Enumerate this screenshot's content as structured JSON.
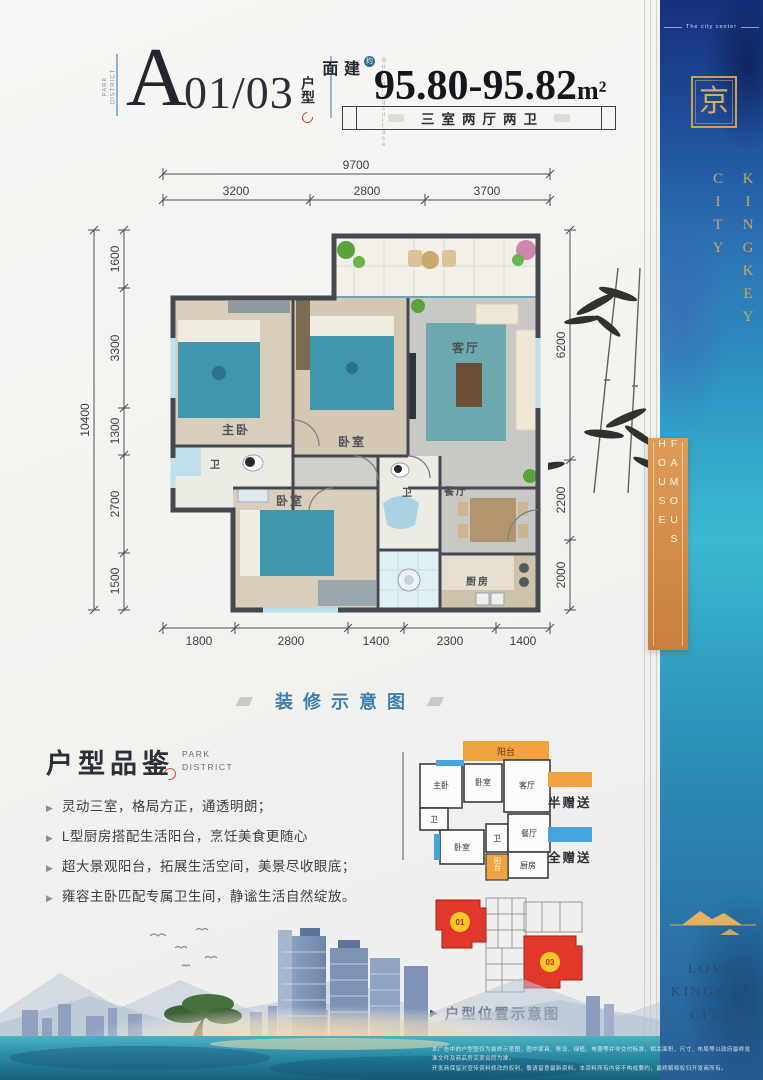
{
  "colors": {
    "accent_blue": "#3d7fae",
    "banner_deep_blue": "#16307c",
    "banner_teal": "#3db9d2",
    "gold": "#c9a04e",
    "famous_orange": "#d18c48",
    "legend_half": "#f0a340",
    "legend_full": "#45a4dc",
    "unit_red": "#e23b2e",
    "unit_yellow": "#f5c928"
  },
  "header": {
    "park_district": "PARK\nDISTRICT",
    "unit_letter": "A",
    "unit_number": "01/03",
    "unit_suffix": "户型",
    "area_prefix": "建面",
    "area_badge": "约",
    "building_surface_caption": "B u i l d i n g   s u r f a c e",
    "area_value": "95.80-95.82",
    "area_unit": "m²",
    "layout_banner": "三室两厅两卫"
  },
  "floorplan": {
    "caption": "装修示意图",
    "dim_top_total": "9700",
    "dim_top": [
      "3200",
      "2800",
      "3700"
    ],
    "dim_left_total": "10400",
    "dim_left": [
      "1600",
      "3300",
      "1300",
      "2700",
      "1500"
    ],
    "dim_right": [
      "6200",
      "2200",
      "2000"
    ],
    "dim_bottom": [
      "1800",
      "2800",
      "1400",
      "2300",
      "1400"
    ],
    "room_master": "主卧",
    "room_bedroom2": "卧室",
    "room_living": "客厅",
    "room_bath1": "卫",
    "room_bedroom3": "卧室",
    "room_bath2": "卫",
    "room_dining": "餐厅",
    "room_kitchen": "厨房"
  },
  "review": {
    "title": "户型品鉴",
    "subtitle": "PARK\nDISTRICT",
    "bullets": [
      "灵动三室，格局方正，通透明朗；",
      "L型厨房搭配生活阳台，烹饪美食更随心",
      "超大景观阳台，拓展生活空间，美景尽收眼底；",
      "雍容主卧匹配专属卫生间，静谧生活自然绽放。"
    ]
  },
  "mini_plan": {
    "balcony_top": "阳台",
    "master": "主卧",
    "bedroom2": "卧室",
    "living": "客厅",
    "bath1": "卫",
    "bedroom3": "卧室",
    "bath2": "卫",
    "dining": "餐厅",
    "balcony_bottom": "阳台",
    "kitchen": "厨房",
    "legend": [
      {
        "label": "半赠送",
        "color": "#f0a340"
      },
      {
        "label": "全赠送",
        "color": "#45a4dc"
      }
    ]
  },
  "location": {
    "unit_a": "01",
    "unit_b": "03",
    "caption": "户型位置示意图"
  },
  "banner": {
    "top_tagline": "The city center",
    "logo_glyph": "京",
    "brand_vertical": "KINGKEY\nCITY",
    "famous_house": "FAMOUS HOUSE",
    "love_text": "LOVE\nKINGKEY\nCITY"
  },
  "footer": {
    "disclaimer_line1": "本广告中的户型图仅为装修示意图，图中家具、陈设、绿植、电器等并非交付标准，相关面积、尺寸、布局等以政府最终批准文件及商品房买卖合同为准。",
    "disclaimer_line2": "开发商保留对宣传资料修改的权利，敬请留意最新资料。本资料所有内容不构成要约，最终解释权归开发商所有。"
  }
}
